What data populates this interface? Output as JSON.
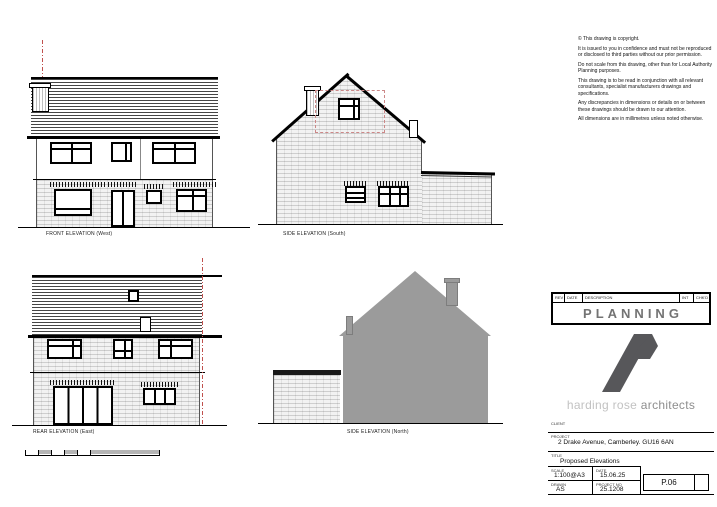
{
  "sheet": {
    "background": "#ffffff"
  },
  "notes": {
    "p1": "© This drawing is copyright.",
    "p2": "It is issued to you in confidence and must not be reproduced or disclosed to third parties without our prior permission.",
    "p3": "Do not scale from this drawing, other than for Local Authority Planning purposes.",
    "p4": "This drawing is to be read in conjunction with all relevant consultants, specialist manufacturers drawings and specifications.",
    "p5": "Any discrepancies in dimensions or details on or between these drawings should be drawn to our attention.",
    "p6": "All dimensions are in millimetres unless noted otherwise."
  },
  "elevations": {
    "front": {
      "label": "FRONT ELEVATION (West)"
    },
    "side_south": {
      "label": "SIDE ELEVATION (South)"
    },
    "rear": {
      "label": "REAR ELEVATION (East)"
    },
    "side_north": {
      "label": "SIDE ELEVATION (North)"
    }
  },
  "title_block": {
    "revision_header": {
      "rev": "REV",
      "date": "DATE",
      "description": "DESCRIPTION",
      "initial": "INT",
      "checked": "CHK'D"
    },
    "status": "PLANNING",
    "practice": {
      "name": "harding rose ",
      "suffix": "architects"
    },
    "client_label": "CLIENT",
    "project_label": "PROJECT",
    "project": "2 Drake Avenue, Camberley. GU16 6AN",
    "title_label": "TITLE",
    "drawing_title": "Proposed Elevations",
    "scale_label": "SCALE",
    "scale": "1:100@A3",
    "date_label": "DATE",
    "date": "15.06.25",
    "drawn_label": "DRAWN",
    "drawn": "AS",
    "project_no_label": "PROJECT NO",
    "project_no": "25.1208",
    "drawing_no": "P.06"
  },
  "colors": {
    "marker_red": "#c0504d",
    "demolition_dash_red": "#cc8888",
    "silhouette_gray": "#9b9b9b",
    "logo_gray": "#57575a",
    "planning_text_gray": "#737373"
  }
}
